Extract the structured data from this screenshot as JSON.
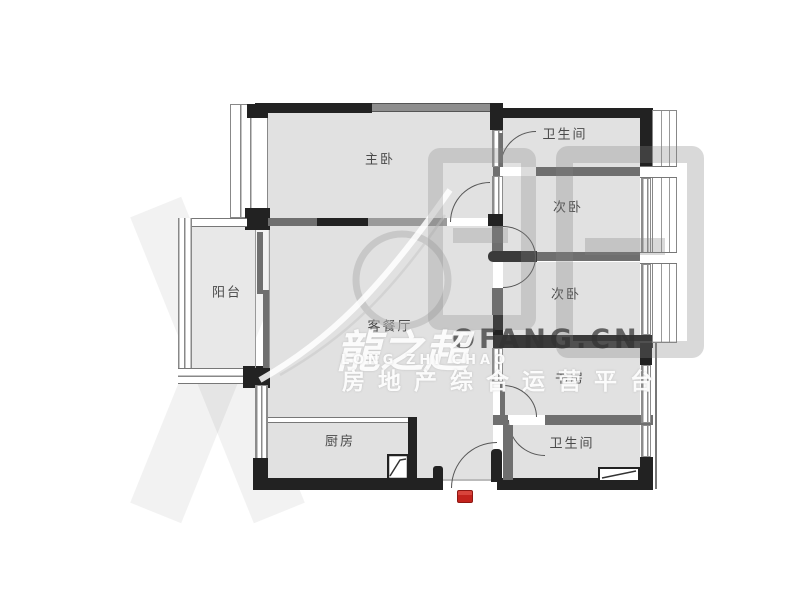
{
  "floor_plan": {
    "rooms": [
      {
        "id": "master-bedroom",
        "label": "主卧"
      },
      {
        "id": "bathroom-top",
        "label": "卫生间"
      },
      {
        "id": "bedroom-second-upper",
        "label": "次卧"
      },
      {
        "id": "bedroom-second-lower",
        "label": "次卧"
      },
      {
        "id": "study",
        "label": "书房"
      },
      {
        "id": "bathroom-bottom",
        "label": "卫生间"
      },
      {
        "id": "living-dining",
        "label": "客餐厅"
      },
      {
        "id": "kitchen",
        "label": "厨房"
      },
      {
        "id": "balcony",
        "label": "阳台"
      }
    ],
    "colors": {
      "wall_black": "#222222",
      "wall_gray": "#6f6f6f",
      "floor": "#e1e1e1",
      "entrance_marker_red": "#c3231d"
    }
  },
  "watermark": {
    "brand_cn": "龍之超",
    "brand_pinyin": "LONG ZHI CHAO",
    "tagline": "房地产综合运营平台",
    "site_text": "OFANG.CN"
  }
}
